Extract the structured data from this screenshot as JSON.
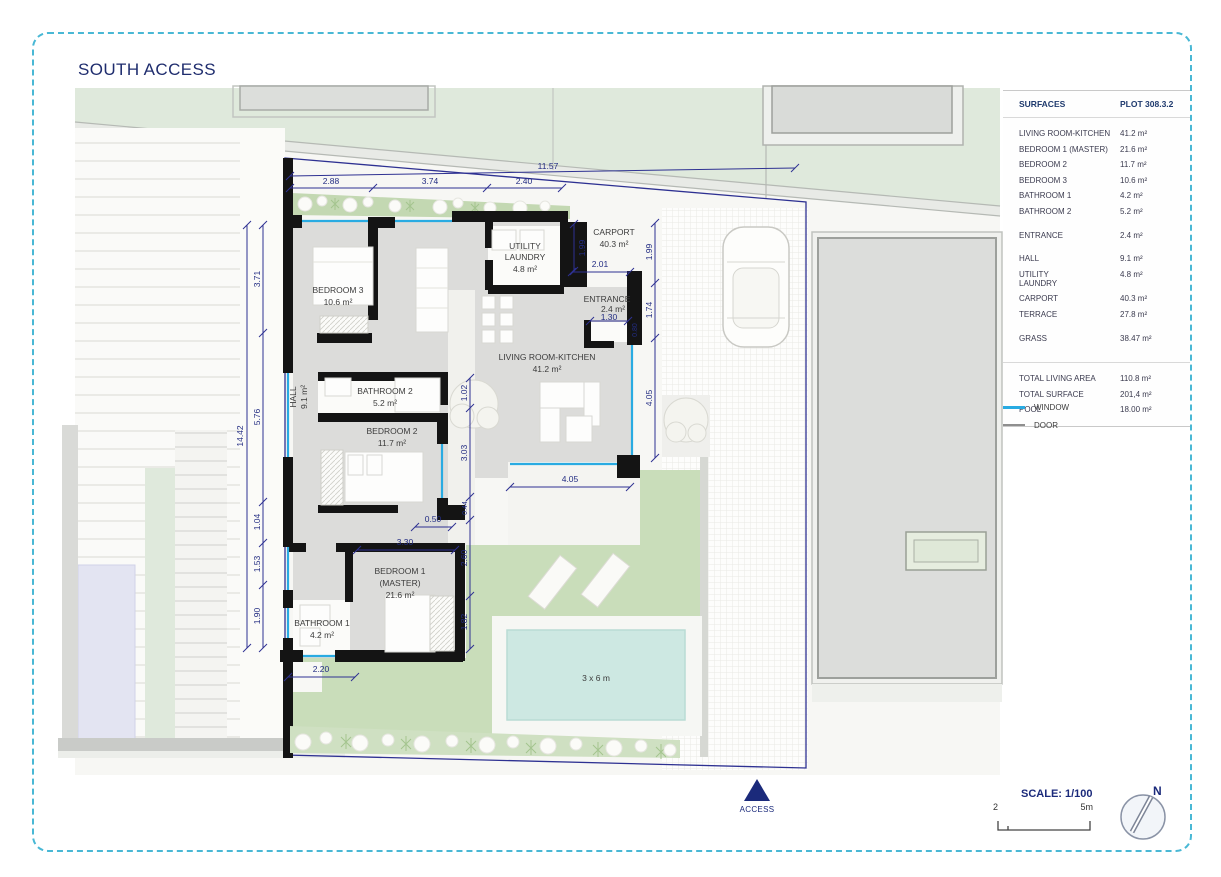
{
  "title": "SOUTH ACCESS",
  "table": {
    "header": {
      "name": "SURFACES",
      "plot": "PLOT 308.3.2"
    },
    "rows": [
      {
        "label": "LIVING ROOM-KITCHEN",
        "value": "41.2 m²"
      },
      {
        "label": "BEDROOM 1 (MASTER)",
        "value": "21.6 m²"
      },
      {
        "label": "BEDROOM 2",
        "value": "11.7 m²"
      },
      {
        "label": "BEDROOM 3",
        "value": "10.6 m²"
      },
      {
        "label": "BATHROOM 1",
        "value": "4.2 m²"
      },
      {
        "label": "BATHROOM 2",
        "value": "5.2 m²"
      },
      {
        "label": "ENTRANCE",
        "value": "2.4 m²"
      },
      {
        "label": "HALL",
        "value": "9.1 m²"
      },
      {
        "label": "UTILITY LAUNDRY",
        "value": "4.8 m²"
      },
      {
        "label": "CARPORT",
        "value": "40.3 m²"
      },
      {
        "label": "TERRACE",
        "value": "27.8 m²"
      },
      {
        "label": "GRASS",
        "value": "38.47 m²"
      }
    ],
    "totals": [
      {
        "label": "TOTAL LIVING AREA",
        "value": "110.8 m²"
      },
      {
        "label": "TOTAL SURFACE",
        "value": "201,4 m²"
      },
      {
        "label": "POOL",
        "value": "18.00 m²"
      }
    ]
  },
  "legend": {
    "window": "WINDOW",
    "door": "DOOR"
  },
  "scalebar": {
    "label": "SCALE: 1/100",
    "start": "2",
    "end": "5m"
  },
  "compass": {
    "north": "N"
  },
  "access_label": "ACCESS",
  "pool_label": "3 x 6 m",
  "rooms": {
    "bedroom3": {
      "name": "BEDROOM 3",
      "area": "10.6 m²"
    },
    "utility": {
      "name1": "UTILITY",
      "name2": "LAUNDRY",
      "area": "4.8 m²"
    },
    "carport": {
      "name": "CARPORT",
      "area": "40.3 m²"
    },
    "entrance": {
      "name": "ENTRANCE",
      "area": "2.4 m²"
    },
    "living": {
      "name": "LIVING ROOM-KITCHEN",
      "area": "41.2 m²"
    },
    "hall": {
      "name": "HALL",
      "area": "9.1 m²"
    },
    "bathroom2": {
      "name": "BATHROOM 2",
      "area": "5.2 m²"
    },
    "bedroom2": {
      "name": "BEDROOM 2",
      "area": "11.7 m²"
    },
    "bedroom1": {
      "name1": "BEDROOM 1",
      "name2": "(MASTER)",
      "area": "21.6 m²"
    },
    "bathroom1": {
      "name": "BATHROOM 1",
      "area": "4.2 m²"
    }
  },
  "dims": {
    "top_total": "11.57",
    "top1": "2.88",
    "top2": "3.74",
    "top3": "2.40",
    "left_total": "14.42",
    "left1": "3.71",
    "left2": "5.76",
    "left3": "1.04",
    "left4": "1.53",
    "left5": "1.90",
    "right1": "1.99",
    "right2": "1.74",
    "right3": "4.05",
    "carport_h": "1.99",
    "carport_w": "2.01",
    "entrance_w": "1.30",
    "entrance_d": "0.80",
    "court1": "1.02",
    "court2": "3.03",
    "court3": "0.44",
    "wall": "0.50",
    "bed1_w": "3.30",
    "bed1_h1": "2.60",
    "bed1_h2": "1.82",
    "bath1_w": "2.20",
    "terrace_w": "4.05"
  },
  "colors": {
    "dimension_navy": "#2e3192",
    "window_blue": "#29abe2",
    "wall_black": "#141414",
    "grass_green": "#c9ddba",
    "pool_water": "#cde8e2",
    "frame_dash_teal": "#49b8d5",
    "title_navy": "#1f2d6e"
  }
}
